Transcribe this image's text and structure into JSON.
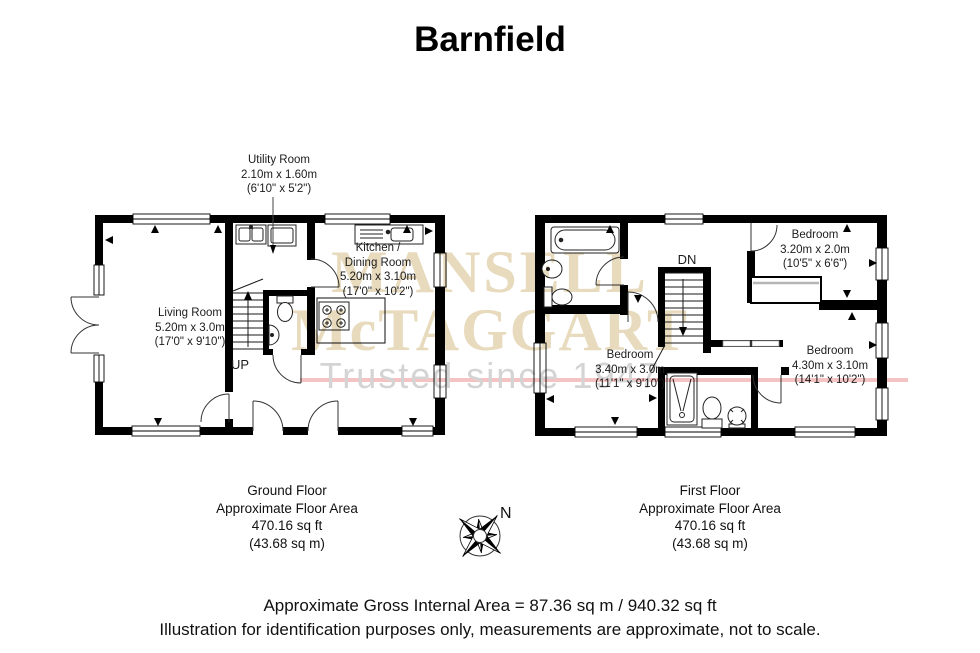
{
  "title": "Barnfield",
  "watermark": {
    "line1": "MANSELL",
    "line2": "McTAGGART",
    "tagline": "Trusted since 1947"
  },
  "ground_floor": {
    "utility": {
      "name": "Utility Room",
      "metric": "2.10m x 1.60m",
      "imperial": "(6'10\" x 5'2\")"
    },
    "living": {
      "name": "Living Room",
      "metric": "5.20m x 3.0m",
      "imperial": "(17'0\" x 9'10\")"
    },
    "kitchen": {
      "name_line1": "Kitchen /",
      "name_line2": "Dining Room",
      "metric": "5.20m x 3.10m",
      "imperial": "(17'0\" x 10'2\")"
    },
    "stairs": "UP",
    "caption": {
      "title": "Ground Floor",
      "subtitle": "Approximate Floor Area",
      "area_ft": "470.16 sq ft",
      "area_m": "(43.68 sq m)"
    }
  },
  "first_floor": {
    "bedroom_top": {
      "name": "Bedroom",
      "metric": "3.20m x 2.0m",
      "imperial": "(10'5\" x 6'6\")"
    },
    "bedroom_left": {
      "name": "Bedroom",
      "metric": "3.40m x 3.0m",
      "imperial": "(11'1\" x 9'10\")"
    },
    "bedroom_right": {
      "name": "Bedroom",
      "metric": "4.30m x 3.10m",
      "imperial": "(14'1\" x 10'2\")"
    },
    "stairs": "DN",
    "caption": {
      "title": "First Floor",
      "subtitle": "Approximate Floor Area",
      "area_ft": "470.16 sq ft",
      "area_m": "(43.68 sq m)"
    }
  },
  "compass": {
    "north": "N"
  },
  "footer": {
    "line1": "Approximate Gross Internal Area = 87.36 sq m / 940.32 sq ft",
    "line2": "Illustration for identification purposes only, measurements are approximate, not to scale."
  },
  "colors": {
    "wall": "#000000",
    "watermark_serif": "#e7dabd",
    "watermark_tagline": "#d4d4d4",
    "watermark_line": "#f4c3c3"
  }
}
